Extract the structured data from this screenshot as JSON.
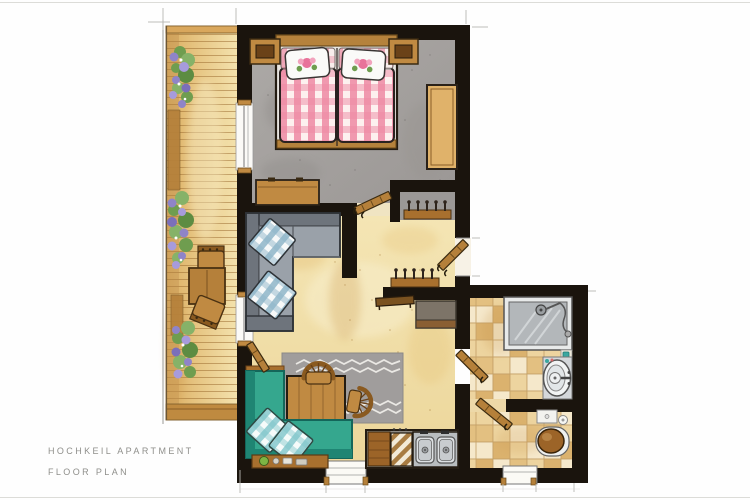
{
  "page": {
    "title": "HOCHKEIL APARTMENT",
    "subtitle": "FLOOR PLAN"
  },
  "colors": {
    "label-gray": "#8f8f8b",
    "wall": "#1a140d",
    "wood": "#c08a42",
    "wood-dark": "#9c6428",
    "wood-light": "#e0b26a",
    "duvet-pink": "#ee8aa4",
    "sofa": "#9aa1a9",
    "sofa-dark": "#6e747c",
    "bench-teal": "#35a78e",
    "bench-teal-dark": "#1f8573",
    "cushion-blue": "#8fb6c9",
    "cushion-teal": "#7fc6cb",
    "rug-gray": "#a09d9c",
    "tile-a": "#f5e7c8",
    "tile-b": "#ecd29a",
    "tile-c": "#e2bd7a",
    "tile-d": "#d9ae66",
    "glass": "#b3b7ba",
    "flower-purple": "#8f84c8",
    "leaf-green": "#6f9d4f"
  }
}
